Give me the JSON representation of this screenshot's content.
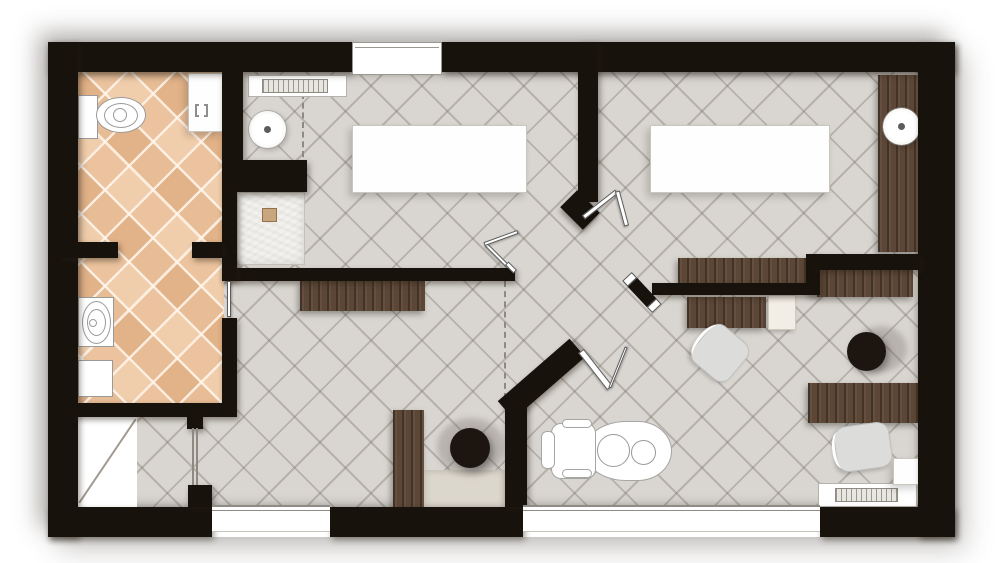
{
  "canvas": {
    "width": 1000,
    "height": 563
  },
  "building": {
    "x": 48,
    "y": 42,
    "w": 907,
    "h": 495
  },
  "palette": {
    "wall": "#18120d",
    "floor_gray": "#d9d5d0",
    "floor_terracotta": "#eac09a",
    "wood": "#5c4636",
    "shower": "#f3f1ed",
    "stool_black": "#1d1610",
    "fixture_outline": "#9a9a9a",
    "background": "#ffffff"
  },
  "render_order": [
    "floors",
    "lines",
    "wood",
    "fixtures",
    "walls",
    "windows",
    "doors"
  ],
  "floors": [
    {
      "n": "main-floor-gray-tile",
      "c": "floor-gray",
      "x": 78,
      "y": 72,
      "w": 842,
      "h": 435
    },
    {
      "n": "bathroom-floor-terracotta",
      "c": "floor-terra",
      "x": 77,
      "y": 72,
      "w": 147,
      "h": 332
    },
    {
      "n": "storage-room-floor-white",
      "c": "room-white",
      "x": 77,
      "y": 417,
      "w": 60,
      "h": 90
    }
  ],
  "lines": [
    {
      "n": "dashed-line-room1",
      "c": "dashed-v",
      "x": 302,
      "y": 93,
      "w": 2,
      "h": 64
    },
    {
      "n": "dashed-line-corridor",
      "c": "dashed-v",
      "x": 504,
      "y": 281,
      "w": 2,
      "h": 118
    },
    {
      "n": "storage-diagonal-line",
      "c": "diag-line",
      "x": 57,
      "y": 460,
      "w": 101,
      "h": 2,
      "r": -56
    }
  ],
  "wood": [
    {
      "n": "right-wall-counter",
      "c": "wood",
      "x": 878,
      "y": 75,
      "w": 40,
      "h": 177
    },
    {
      "n": "room2-wall-desk",
      "c": "wood",
      "x": 678,
      "y": 258,
      "w": 130,
      "h": 25
    },
    {
      "n": "office-upper-desk",
      "c": "wood",
      "x": 817,
      "y": 268,
      "w": 96,
      "h": 29
    },
    {
      "n": "office-drawer-unit",
      "c": "wood",
      "x": 687,
      "y": 297,
      "w": 79,
      "h": 31
    },
    {
      "n": "office-lower-desk",
      "c": "wood",
      "x": 808,
      "y": 383,
      "w": 110,
      "h": 40
    },
    {
      "n": "corridor-console",
      "c": "wood",
      "x": 300,
      "y": 281,
      "w": 125,
      "h": 30
    },
    {
      "n": "corridor-tall-cabinet",
      "c": "wood",
      "x": 393,
      "y": 410,
      "w": 31,
      "h": 97
    }
  ],
  "fixtures": [
    {
      "n": "corridor-counter-top",
      "c": "counter-light",
      "x": 424,
      "y": 470,
      "w": 81,
      "h": 37
    },
    {
      "n": "room1-table",
      "c": "white-box",
      "x": 352,
      "y": 125,
      "w": 175,
      "h": 68
    },
    {
      "n": "room2-table",
      "c": "white-box",
      "x": 650,
      "y": 125,
      "w": 180,
      "h": 68
    },
    {
      "n": "room1-radiator",
      "c": "radiator",
      "x": 248,
      "y": 75,
      "w": 99,
      "h": 22
    },
    {
      "n": "room1-radiator-core",
      "c": "rad-core",
      "x": 262,
      "y": 79,
      "w": 66,
      "h": 14
    },
    {
      "n": "office-radiator",
      "c": "radiator",
      "x": 818,
      "y": 483,
      "w": 99,
      "h": 24
    },
    {
      "n": "office-radiator-core",
      "c": "rad-core",
      "x": 835,
      "y": 488,
      "w": 63,
      "h": 14
    },
    {
      "n": "office-corner-table",
      "c": "white-box",
      "x": 893,
      "y": 458,
      "w": 27,
      "h": 27
    },
    {
      "n": "bathroom-cabinet-top",
      "c": "white-box",
      "x": 188,
      "y": 73,
      "w": 35,
      "h": 59
    },
    {
      "n": "bathroom-cabinet-symbol",
      "c": "bracket",
      "x": 195,
      "y": 104,
      "w": 13,
      "h": 13
    },
    {
      "n": "toilet-tank",
      "c": "outline",
      "x": 78,
      "y": 95,
      "w": 20,
      "h": 44
    },
    {
      "n": "toilet-bowl",
      "c": "outline ellipse",
      "x": 96,
      "y": 97,
      "w": 50,
      "h": 36
    },
    {
      "n": "toilet-bowl-inner",
      "c": "oline",
      "x": 104,
      "y": 103,
      "w": 34,
      "h": 25
    },
    {
      "n": "toilet-flush",
      "c": "oline",
      "x": 113,
      "y": 108,
      "w": 14,
      "h": 14
    },
    {
      "n": "shower-tray",
      "c": "shower",
      "x": 237,
      "y": 192,
      "w": 68,
      "h": 73
    },
    {
      "n": "shower-drain",
      "c": "drain",
      "x": 262,
      "y": 208,
      "w": 15,
      "h": 14
    },
    {
      "n": "room1-pedestal-sink",
      "c": "ring",
      "x": 249,
      "y": 111,
      "w": 37,
      "h": 37
    },
    {
      "n": "room1-sink-drain-dot",
      "c": "dot",
      "x": 264,
      "y": 126,
      "w": 7,
      "h": 7
    },
    {
      "n": "room2-pedestal-sink",
      "c": "ring",
      "x": 883,
      "y": 108,
      "w": 37,
      "h": 37
    },
    {
      "n": "room2-sink-drain-dot",
      "c": "dot",
      "x": 898,
      "y": 123,
      "w": 7,
      "h": 7
    },
    {
      "n": "bathroom-sink-counter",
      "c": "outline",
      "x": 78,
      "y": 297,
      "w": 36,
      "h": 50
    },
    {
      "n": "bathroom-sink-basin",
      "c": "oline",
      "x": 82,
      "y": 301,
      "w": 29,
      "h": 43
    },
    {
      "n": "bathroom-sink-inner",
      "c": "oline",
      "x": 87,
      "y": 309,
      "w": 19,
      "h": 27
    },
    {
      "n": "bathroom-sink-faucet",
      "c": "oline",
      "x": 89,
      "y": 319,
      "w": 8,
      "h": 8
    },
    {
      "n": "bathroom-cabinet-bottom",
      "c": "outline",
      "x": 78,
      "y": 360,
      "w": 35,
      "h": 37
    },
    {
      "n": "office-printer",
      "c": "printer",
      "x": 768,
      "y": 295,
      "w": 28,
      "h": 35
    },
    {
      "n": "corridor-stool-shadow",
      "c": "halo",
      "x": 437,
      "y": 418,
      "w": 68,
      "h": 58
    },
    {
      "n": "corridor-stool",
      "c": "stool",
      "x": 450,
      "y": 428,
      "w": 40,
      "h": 40
    },
    {
      "n": "office-stool-shadow",
      "c": "halo",
      "x": 855,
      "y": 326,
      "w": 52,
      "h": 46
    },
    {
      "n": "office-stool",
      "c": "stool",
      "x": 847,
      "y": 332,
      "w": 39,
      "h": 39
    },
    {
      "n": "office-chair-1",
      "c": "chair",
      "x": 696,
      "y": 329,
      "w": 48,
      "h": 48,
      "r": 40
    },
    {
      "n": "office-chair-2",
      "c": "chair",
      "x": 835,
      "y": 424,
      "w": 56,
      "h": 46,
      "r": -8
    },
    {
      "n": "dental-chair-body",
      "c": "dchair",
      "x": 584,
      "y": 421,
      "w": 88,
      "h": 60,
      "br": "42px 34px 34px 42px / 30px"
    },
    {
      "n": "dental-chair-backrest",
      "c": "dchair",
      "x": 551,
      "y": 423,
      "w": 45,
      "h": 56,
      "br": "10px"
    },
    {
      "n": "dental-chair-headrest",
      "c": "dchair",
      "x": 541,
      "y": 431,
      "w": 14,
      "h": 38,
      "br": "6px"
    },
    {
      "n": "dental-chair-armrest-top",
      "c": "dchair",
      "x": 562,
      "y": 419,
      "w": 30,
      "h": 9,
      "br": "5px"
    },
    {
      "n": "dental-chair-armrest-bottom",
      "c": "dchair",
      "x": 562,
      "y": 469,
      "w": 30,
      "h": 9,
      "br": "5px"
    },
    {
      "n": "dental-chair-seat-circle",
      "c": "oline",
      "x": 597,
      "y": 434,
      "w": 33,
      "h": 33
    },
    {
      "n": "dental-chair-foot-circle",
      "c": "oline",
      "x": 631,
      "y": 440,
      "w": 25,
      "h": 25
    }
  ],
  "walls": [
    {
      "n": "wall-top-left",
      "c": "wall",
      "x": 48,
      "y": 42,
      "w": 304,
      "h": 30
    },
    {
      "n": "wall-top-right",
      "c": "wall",
      "x": 442,
      "y": 42,
      "w": 513,
      "h": 30
    },
    {
      "n": "wall-left",
      "c": "wall",
      "x": 48,
      "y": 42,
      "w": 30,
      "h": 495
    },
    {
      "n": "wall-right",
      "c": "wall",
      "x": 918,
      "y": 42,
      "w": 37,
      "h": 495
    },
    {
      "n": "wall-bottom-1",
      "c": "wall",
      "x": 48,
      "y": 507,
      "w": 164,
      "h": 30
    },
    {
      "n": "wall-bottom-2",
      "c": "wall",
      "x": 330,
      "y": 507,
      "w": 193,
      "h": 30
    },
    {
      "n": "wall-bottom-3",
      "c": "wall",
      "x": 820,
      "y": 507,
      "w": 135,
      "h": 30
    },
    {
      "n": "wall-bathroom-east-upper",
      "c": "wall",
      "x": 222,
      "y": 72,
      "w": 21,
      "h": 88
    },
    {
      "n": "wall-shower-north",
      "c": "wall",
      "x": 222,
      "y": 160,
      "w": 85,
      "h": 32
    },
    {
      "n": "wall-shower-west",
      "c": "wall",
      "x": 222,
      "y": 192,
      "w": 15,
      "h": 76
    },
    {
      "n": "wall-room1-south",
      "c": "wall",
      "x": 222,
      "y": 268,
      "w": 293,
      "h": 13
    },
    {
      "n": "wall-bathroom-stub-left",
      "c": "wall",
      "x": 60,
      "y": 242,
      "w": 58,
      "h": 16
    },
    {
      "n": "wall-bathroom-stub-right",
      "c": "wall",
      "x": 192,
      "y": 242,
      "w": 31,
      "h": 16
    },
    {
      "n": "wall-bathroom-east-mid",
      "c": "wall",
      "x": 222,
      "y": 258,
      "w": 15,
      "h": 22
    },
    {
      "n": "wall-bathroom-east-low",
      "c": "wall",
      "x": 222,
      "y": 318,
      "w": 15,
      "h": 85
    },
    {
      "n": "wall-bathroom-south",
      "c": "wall",
      "x": 73,
      "y": 403,
      "w": 164,
      "h": 14
    },
    {
      "n": "wall-stub-below-bathroom",
      "c": "wall",
      "x": 187,
      "y": 417,
      "w": 16,
      "h": 12
    },
    {
      "n": "wall-glass-door-stub",
      "c": "wall",
      "x": 188,
      "y": 485,
      "w": 24,
      "h": 22
    },
    {
      "n": "wall-partition-room1-room2",
      "c": "wall",
      "x": 578,
      "y": 42,
      "w": 20,
      "h": 160
    },
    {
      "n": "wall-partition-end-block",
      "c": "wall",
      "x": 564,
      "y": 198,
      "w": 32,
      "h": 24,
      "r": 45
    },
    {
      "n": "wall-room2-south",
      "c": "wall",
      "x": 652,
      "y": 283,
      "w": 160,
      "h": 12
    },
    {
      "n": "wall-connector",
      "c": "wall",
      "x": 806,
      "y": 254,
      "w": 14,
      "h": 41
    },
    {
      "n": "wall-office-north",
      "c": "wall",
      "x": 817,
      "y": 254,
      "w": 103,
      "h": 16
    },
    {
      "n": "wall-diagonal",
      "c": "wall",
      "x": 494,
      "y": 367,
      "w": 95,
      "h": 24,
      "r": -41
    },
    {
      "n": "wall-south-vertical",
      "c": "wall",
      "x": 505,
      "y": 400,
      "w": 22,
      "h": 107
    }
  ],
  "windows": [
    {
      "n": "window-top",
      "c": "win-top",
      "x": 352,
      "y": 42,
      "w": 90,
      "h": 33
    },
    {
      "n": "window-bottom-left",
      "c": "win-b",
      "x": 212,
      "y": 505,
      "w": 118,
      "h": 27
    },
    {
      "n": "window-bottom-center",
      "c": "win-b",
      "x": 523,
      "y": 505,
      "w": 297,
      "h": 27
    }
  ],
  "doors": [
    {
      "n": "glass-door-storage",
      "c": "glass2",
      "x": 192,
      "y": 428,
      "w": 6,
      "h": 57
    },
    {
      "n": "bathroom-sliding-leaf",
      "c": "leaf-w",
      "x": 227,
      "y": 281,
      "w": 4,
      "h": 36
    },
    {
      "n": "room1-door-leaf-a",
      "c": "leaf-w",
      "x": 481,
      "y": 253,
      "w": 31,
      "h": 4,
      "r": 45
    },
    {
      "n": "room1-door-leaf-b",
      "c": "leaf-w",
      "x": 483,
      "y": 236,
      "w": 36,
      "h": 4,
      "r": -20
    },
    {
      "n": "wall-tip-cap",
      "c": "leaf-w",
      "x": 505,
      "y": 265,
      "w": 12,
      "h": 5,
      "r": 45
    },
    {
      "n": "double-door-leaf-a",
      "c": "leaf-w",
      "x": 579,
      "y": 202,
      "w": 42,
      "h": 5,
      "r": -38
    },
    {
      "n": "double-door-leaf-b",
      "c": "leaf-w",
      "x": 604,
      "y": 206,
      "w": 36,
      "h": 5,
      "r": 75
    },
    {
      "n": "diagonal-wall-door-leaf",
      "c": "leaf-w",
      "x": 572,
      "y": 366,
      "w": 47,
      "h": 7,
      "r": 52
    },
    {
      "n": "diagonal-wall-door-swing",
      "c": "leaf-w",
      "x": 596,
      "y": 366,
      "w": 44,
      "h": 3,
      "r": -68
    },
    {
      "n": "room2-door-leaf-black",
      "c": "leaf-b",
      "x": 622,
      "y": 286,
      "w": 40,
      "h": 13,
      "r": 47
    }
  ]
}
